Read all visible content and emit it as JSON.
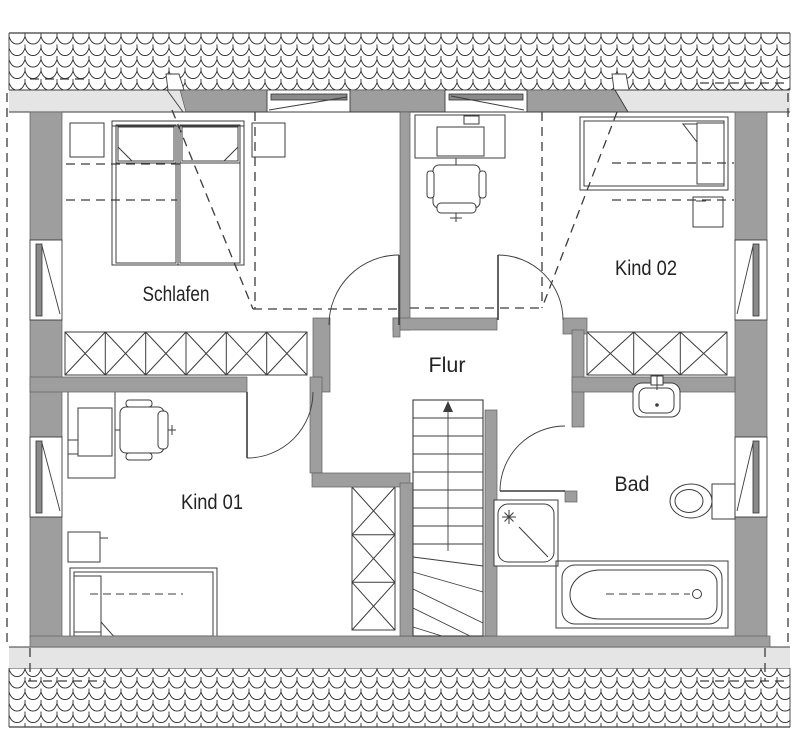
{
  "plan": {
    "type": "floor-plan",
    "floor_labels": {
      "schlafen": "Schlafen",
      "kind02": "Kind 02",
      "flur": "Flur",
      "kind01": "Kind 01",
      "bad": "Bad"
    },
    "rooms": [
      {
        "name": "schlafen",
        "label": "Schlafen"
      },
      {
        "name": "kind-02",
        "label": "Kind 02"
      },
      {
        "name": "flur",
        "label": "Flur"
      },
      {
        "name": "kind-01",
        "label": "Kind 01"
      },
      {
        "name": "bad",
        "label": "Bad"
      }
    ],
    "colors": {
      "wall_fill": "#9e9e9e",
      "eaves_fill": "#e5e5e5",
      "line": "#3c3c3c",
      "background": "#ffffff"
    },
    "symbols": [
      "roof-tiles",
      "double-bed",
      "single-bed",
      "nightstand",
      "wardrobe",
      "desk",
      "monitor",
      "office-chair",
      "stairs-up-arrow",
      "door-swing",
      "window",
      "washbasin",
      "toilet",
      "shower",
      "bathtub"
    ]
  }
}
